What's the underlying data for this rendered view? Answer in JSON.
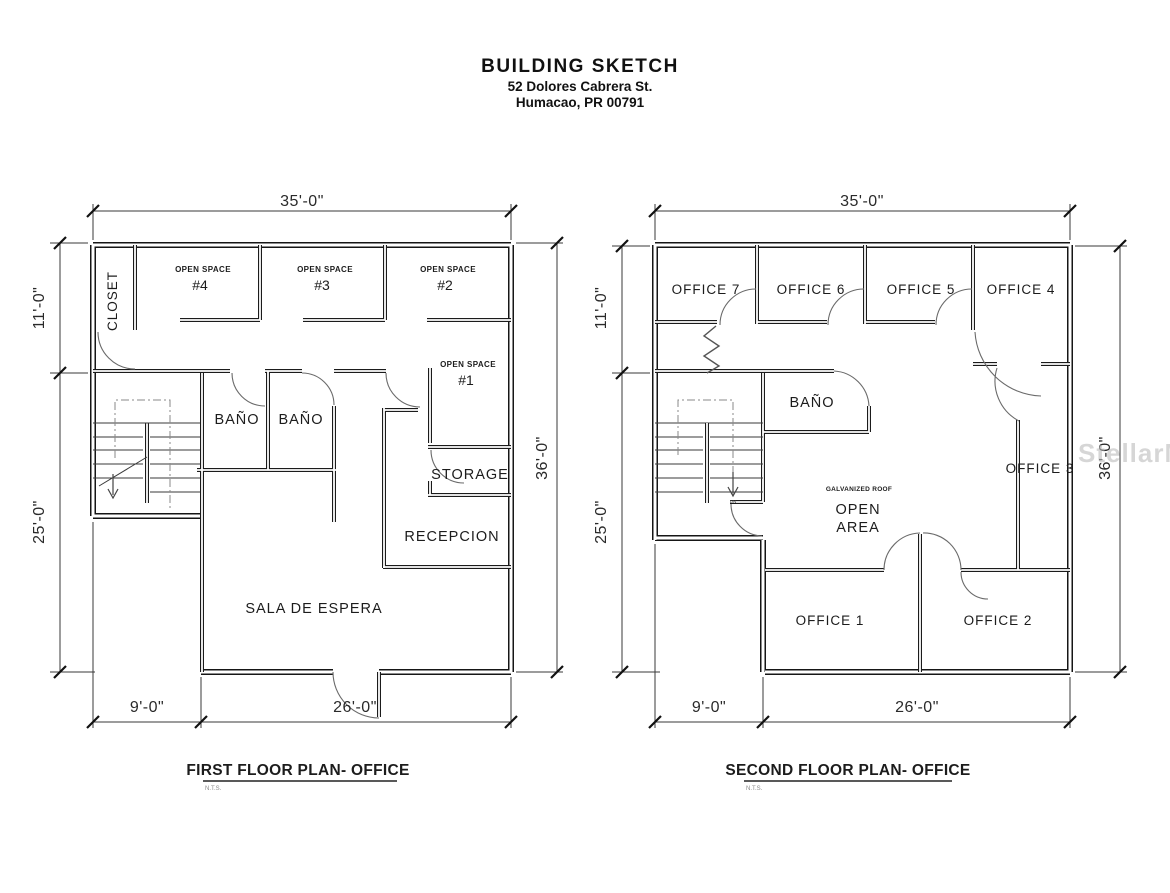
{
  "header": {
    "title": "BUILDING SKETCH",
    "address1": "52 Dolores Cabrera St.",
    "address2": "Humacao, PR 00791"
  },
  "watermark": "StellarMLS",
  "first_floor": {
    "title": "FIRST FLOOR PLAN-  OFFICE",
    "scale_note": "N.T.S.",
    "dims": {
      "top": "35'-0\"",
      "left_upper": "11'-0\"",
      "left_lower": "25'-0\"",
      "right": "36'-0\"",
      "bottom_left": "9'-0\"",
      "bottom_right": "26'-0\""
    },
    "rooms": {
      "closet": "CLOSET",
      "open_space": "OPEN SPACE",
      "unit4": "#4",
      "unit3": "#3",
      "unit2": "#2",
      "unit1": "#1",
      "bano_left": "BAÑO",
      "bano_right": "BAÑO",
      "storage": "STORAGE",
      "reception": "RECEPCION",
      "waiting": "SALA DE ESPERA"
    }
  },
  "second_floor": {
    "title": "SECOND FLOOR PLAN- OFFICE",
    "scale_note": "N.T.S.",
    "stair_note": "DN",
    "dims": {
      "top": "35'-0\"",
      "left_upper": "11'-0\"",
      "left_lower": "25'-0\"",
      "right": "36'-0\"",
      "bottom_left": "9'-0\"",
      "bottom_right": "26'-0\""
    },
    "rooms": {
      "office7": "OFFICE 7",
      "office6": "OFFICE 6",
      "office5": "OFFICE 5",
      "office4": "OFFICE 4",
      "bano": "BAÑO",
      "office3": "OFFICE 3",
      "roof_note": "GALVANIZED ROOF",
      "open_line1": "OPEN",
      "open_line2": "AREA",
      "office1": "OFFICE 1",
      "office2": "OFFICE 2"
    }
  }
}
